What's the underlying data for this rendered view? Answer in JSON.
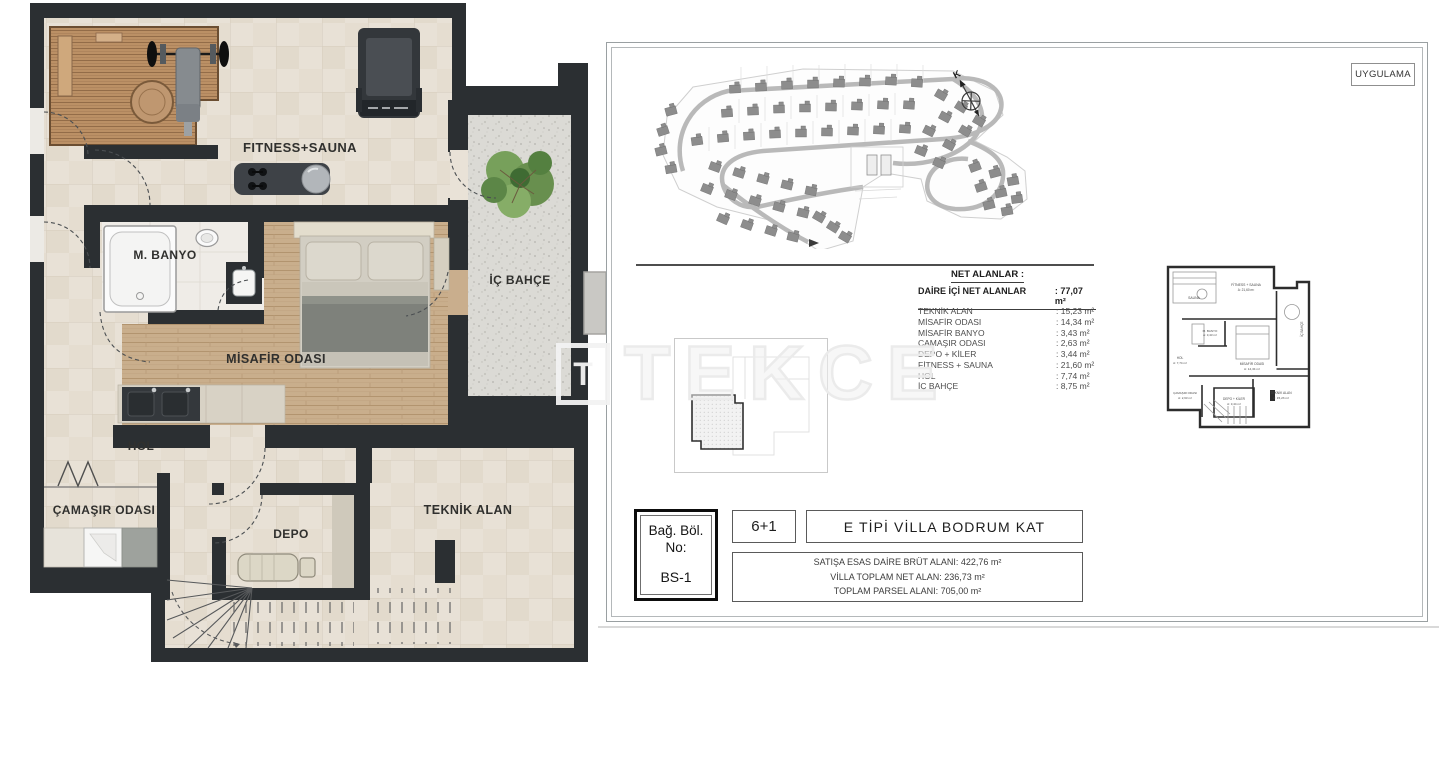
{
  "watermark": "TEKCE",
  "floor_plan": {
    "rooms": {
      "fitness_sauna": "FITNESS+SAUNA",
      "m_banyo": "M. BANYO",
      "misafir_odasi": "MİSAFİR ODASI",
      "ic_bahce": "İÇ BAHÇE",
      "hol": "HOL",
      "camasir_odasi": "ÇAMAŞIR ODASI",
      "depo": "DEPO",
      "teknik_alan": "TEKNİK ALAN"
    }
  },
  "panel": {
    "stamp": "UYGULAMA",
    "compass": "K",
    "net_areas": {
      "title": "NET ALANLAR :",
      "subtitle": "DAİRE İÇİ NET ALANLAR",
      "subtitle_value": ": 77,07 m²",
      "rows": [
        {
          "label": "TEKNİK ALAN",
          "value": ": 15,23 m²"
        },
        {
          "label": "MİSAFİR ODASI",
          "value": ": 14,34 m²"
        },
        {
          "label": "MİSAFİR BANYO",
          "value": ": 3,43 m²"
        },
        {
          "label": "ÇAMAŞIR ODASI",
          "value": ": 2,63 m²"
        },
        {
          "label": "DEPO + KİLER",
          "value": ": 3,44 m²"
        },
        {
          "label": "FİTNESS + SAUNA",
          "value": ": 21,60 m²"
        },
        {
          "label": "HOL",
          "value": ": 7,74 m²"
        },
        {
          "label": "İÇ BAHÇE",
          "value": ": 8,75 m²"
        }
      ]
    },
    "mini_plan": {
      "labels": [
        "SAUNA",
        "FİTNESS + SAUNA",
        "A: 21,60 m²",
        "M. BANYO",
        "A: 3,43 m²",
        "MİSAFİR ODASI",
        "A: 14,34 m²",
        "HOL",
        "A: 7,74 m²",
        "ÇAMAŞIR ODASI",
        "A: 2,63 m²",
        "DEPO + KİLER",
        "A: 3,44 m²",
        "TEKNİK ALAN",
        "A: 15,23 m²",
        "İÇ BAHÇE"
      ]
    },
    "title_block": {
      "unit_label_line1": "Bağ. Böl.",
      "unit_label_line2": "No:",
      "unit_no": "BS-1",
      "room_count": "6+1",
      "drawing_title": "E TİPİ VİLLA  BODRUM KAT",
      "area_lines": [
        "SATIŞA ESAS DAİRE BRÜT ALANI: 422,76 m²",
        "VİLLA TOPLAM NET ALAN: 236,73 m²",
        "TOPLAM PARSEL ALANI: 705,00 m²"
      ]
    }
  }
}
